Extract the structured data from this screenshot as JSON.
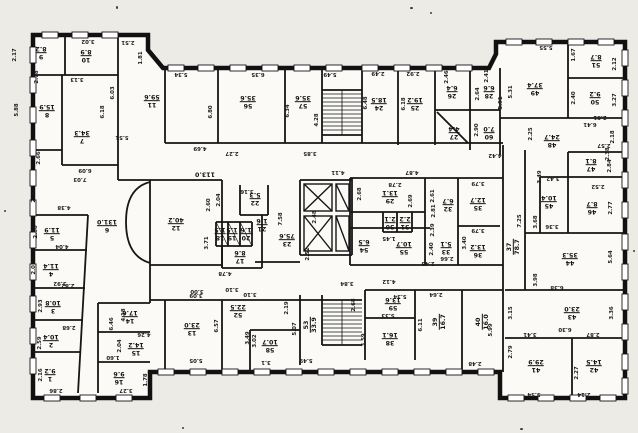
{
  "colors": {
    "paper": "#edebe6",
    "ink": "#161616",
    "wall": "#111111"
  },
  "rooms": [
    {
      "n": "1",
      "a": "9.2",
      "x": 50,
      "y": 374
    },
    {
      "n": "2",
      "a": "10.4",
      "x": 51,
      "y": 340
    },
    {
      "n": "3",
      "a": "10.8",
      "x": 53,
      "y": 306
    },
    {
      "n": "4",
      "a": "11.4",
      "x": 51,
      "y": 269
    },
    {
      "n": "5",
      "a": "11.9",
      "x": 52,
      "y": 233
    },
    {
      "n": "6",
      "a": "131.0",
      "x": 107,
      "y": 225
    },
    {
      "n": "7",
      "a": "34.3",
      "x": 82,
      "y": 136
    },
    {
      "n": "8",
      "a": "15.9",
      "x": 47,
      "y": 110
    },
    {
      "n": "9",
      "a": "8.2",
      "x": 41,
      "y": 52
    },
    {
      "n": "10",
      "a": "8.9",
      "x": 86,
      "y": 55
    },
    {
      "n": "11",
      "a": "59.6",
      "x": 152,
      "y": 100
    },
    {
      "n": "12",
      "a": "40.2",
      "x": 176,
      "y": 223
    },
    {
      "n": "13",
      "a": "23.0",
      "x": 192,
      "y": 328
    },
    {
      "n": "14",
      "a": "17.6",
      "x": 130,
      "y": 316
    },
    {
      "n": "15",
      "a": "14.2",
      "x": 136,
      "y": 348
    },
    {
      "n": "16",
      "a": "9.6",
      "x": 119,
      "y": 377
    },
    {
      "n": "17",
      "a": "8.6",
      "x": 240,
      "y": 256
    },
    {
      "n": "18",
      "a": "1.5",
      "x": 220,
      "y": 233
    },
    {
      "n": "19",
      "a": "1.5",
      "x": 232,
      "y": 233
    },
    {
      "n": "20",
      "a": "1.6",
      "x": 246,
      "y": 233
    },
    {
      "n": "21",
      "a": "1.6",
      "x": 262,
      "y": 224
    },
    {
      "n": "22",
      "a": "5.3",
      "x": 255,
      "y": 198
    },
    {
      "n": "23",
      "a": "75.6",
      "x": 287,
      "y": 239
    },
    {
      "n": "24",
      "a": "18.5",
      "x": 379,
      "y": 103
    },
    {
      "n": "25",
      "a": "19.2",
      "x": 415,
      "y": 103
    },
    {
      "n": "26",
      "a": "6.4",
      "x": 452,
      "y": 91
    },
    {
      "n": "27",
      "a": "4.4",
      "x": 454,
      "y": 132
    },
    {
      "n": "28",
      "a": "6.6",
      "x": 489,
      "y": 91
    },
    {
      "n": "29",
      "a": "13.1",
      "x": 390,
      "y": 196
    },
    {
      "n": "30",
      "a": "2.1",
      "x": 390,
      "y": 222
    },
    {
      "n": "31",
      "a": "2.2",
      "x": 405,
      "y": 222
    },
    {
      "n": "32",
      "a": "6.7",
      "x": 448,
      "y": 204
    },
    {
      "n": "33",
      "a": "5.1",
      "x": 446,
      "y": 247
    },
    {
      "n": "35",
      "a": "12.7",
      "x": 478,
      "y": 203
    },
    {
      "n": "36",
      "a": "13.2",
      "x": 478,
      "y": 250
    },
    {
      "n": "37",
      "a": "78.7",
      "x": 514,
      "y": 247,
      "v": true
    },
    {
      "n": "38",
      "a": "16.1",
      "x": 390,
      "y": 338
    },
    {
      "n": "39",
      "a": "16.7",
      "x": 440,
      "y": 322,
      "v": true
    },
    {
      "n": "40",
      "a": "16.0",
      "x": 483,
      "y": 322,
      "v": true
    },
    {
      "n": "41",
      "a": "29.9",
      "x": 536,
      "y": 365
    },
    {
      "n": "42",
      "a": "14.5",
      "x": 594,
      "y": 365
    },
    {
      "n": "43",
      "a": "23.0",
      "x": 572,
      "y": 312
    },
    {
      "n": "44",
      "a": "35.3",
      "x": 570,
      "y": 258
    },
    {
      "n": "45",
      "a": "10.4",
      "x": 549,
      "y": 201
    },
    {
      "n": "46",
      "a": "8.7",
      "x": 592,
      "y": 207
    },
    {
      "n": "47",
      "a": "8.1",
      "x": 591,
      "y": 164
    },
    {
      "n": "48",
      "a": "24.7",
      "x": 552,
      "y": 140
    },
    {
      "n": "49",
      "a": "37.4",
      "x": 535,
      "y": 88
    },
    {
      "n": "50",
      "a": "9.2",
      "x": 595,
      "y": 97
    },
    {
      "n": "51",
      "a": "8.7",
      "x": 596,
      "y": 60
    },
    {
      "n": "52",
      "a": "22.5",
      "x": 238,
      "y": 310
    },
    {
      "n": "53",
      "a": "33.9",
      "x": 311,
      "y": 325,
      "v": true
    },
    {
      "n": "54",
      "a": "6.5",
      "x": 364,
      "y": 245
    },
    {
      "n": "55",
      "a": "10.7",
      "x": 404,
      "y": 247
    },
    {
      "n": "56",
      "a": "35.6",
      "x": 248,
      "y": 101
    },
    {
      "n": "57",
      "a": "35.6",
      "x": 303,
      "y": 101
    },
    {
      "n": "58",
      "a": "10.7",
      "x": 270,
      "y": 345
    },
    {
      "n": "59",
      "a": "13.6",
      "x": 393,
      "y": 303
    },
    {
      "n": "60",
      "a": "7.0",
      "x": 489,
      "y": 132
    },
    {
      "n": "",
      "a": "113.0",
      "x": 205,
      "y": 174
    }
  ],
  "dims": [
    {
      "t": "2.17",
      "x": 15,
      "y": 55,
      "v": true
    },
    {
      "t": "3.02",
      "x": 88,
      "y": 41
    },
    {
      "t": "2.51",
      "x": 128,
      "y": 42
    },
    {
      "t": "1.81",
      "x": 141,
      "y": 58,
      "v": true
    },
    {
      "t": "5.34",
      "x": 181,
      "y": 74
    },
    {
      "t": "6.35",
      "x": 258,
      "y": 74
    },
    {
      "t": "5.49",
      "x": 330,
      "y": 74
    },
    {
      "t": "2.78",
      "x": 37,
      "y": 77,
      "v": true
    },
    {
      "t": "3.13",
      "x": 77,
      "y": 79
    },
    {
      "t": "6.03",
      "x": 113,
      "y": 93,
      "v": true
    },
    {
      "t": "5.88",
      "x": 17,
      "y": 110,
      "v": true
    },
    {
      "t": "6.18",
      "x": 103,
      "y": 112,
      "v": true
    },
    {
      "t": "6.80",
      "x": 211,
      "y": 112,
      "v": true
    },
    {
      "t": "6.34",
      "x": 288,
      "y": 111,
      "v": true
    },
    {
      "t": "4.28",
      "x": 317,
      "y": 120,
      "v": true
    },
    {
      "t": "5.51",
      "x": 122,
      "y": 137
    },
    {
      "t": "4.69",
      "x": 200,
      "y": 148
    },
    {
      "t": "2.27",
      "x": 232,
      "y": 153
    },
    {
      "t": "3.85",
      "x": 310,
      "y": 153
    },
    {
      "t": "2.49",
      "x": 378,
      "y": 73
    },
    {
      "t": "2.92",
      "x": 413,
      "y": 73
    },
    {
      "t": "2.46",
      "x": 447,
      "y": 77,
      "v": true
    },
    {
      "t": "2.41",
      "x": 487,
      "y": 76,
      "v": true
    },
    {
      "t": "2.64",
      "x": 478,
      "y": 94,
      "v": true
    },
    {
      "t": "2.90",
      "x": 477,
      "y": 130,
      "v": true
    },
    {
      "t": "5.91",
      "x": 501,
      "y": 103,
      "v": true
    },
    {
      "t": "6.48",
      "x": 366,
      "y": 103,
      "v": true
    },
    {
      "t": "6.18",
      "x": 404,
      "y": 104,
      "v": true
    },
    {
      "t": "4.42",
      "x": 495,
      "y": 155
    },
    {
      "t": "5.55",
      "x": 546,
      "y": 47
    },
    {
      "t": "1.67",
      "x": 574,
      "y": 55,
      "v": true
    },
    {
      "t": "2.12",
      "x": 615,
      "y": 64,
      "v": true
    },
    {
      "t": "5.31",
      "x": 511,
      "y": 92,
      "v": true
    },
    {
      "t": "3.27",
      "x": 615,
      "y": 100,
      "v": true
    },
    {
      "t": "2.40",
      "x": 574,
      "y": 98,
      "v": true
    },
    {
      "t": "2.81",
      "x": 600,
      "y": 117
    },
    {
      "t": "6.41",
      "x": 590,
      "y": 124
    },
    {
      "t": "2.25",
      "x": 531,
      "y": 134,
      "v": true
    },
    {
      "t": "2.18",
      "x": 613,
      "y": 137,
      "v": true
    },
    {
      "t": "2.57",
      "x": 604,
      "y": 145
    },
    {
      "t": "2.38",
      "x": 608,
      "y": 154,
      "v": true
    },
    {
      "t": "2.84",
      "x": 610,
      "y": 166,
      "v": true
    },
    {
      "t": "2.52",
      "x": 598,
      "y": 186
    },
    {
      "t": "2.77",
      "x": 611,
      "y": 208,
      "v": true
    },
    {
      "t": "3.42",
      "x": 553,
      "y": 178
    },
    {
      "t": "3.36",
      "x": 552,
      "y": 226
    },
    {
      "t": "5.64",
      "x": 611,
      "y": 257,
      "v": true
    },
    {
      "t": "6.38",
      "x": 557,
      "y": 287
    },
    {
      "t": "3.36",
      "x": 612,
      "y": 313,
      "v": true
    },
    {
      "t": "3.15",
      "x": 511,
      "y": 313,
      "v": true
    },
    {
      "t": "6.30",
      "x": 565,
      "y": 329
    },
    {
      "t": "3.41",
      "x": 530,
      "y": 334
    },
    {
      "t": "2.87",
      "x": 593,
      "y": 334
    },
    {
      "t": "2.79",
      "x": 511,
      "y": 352,
      "v": true
    },
    {
      "t": "2.27",
      "x": 577,
      "y": 373,
      "v": true
    },
    {
      "t": "5.54",
      "x": 534,
      "y": 394
    },
    {
      "t": "2.14",
      "x": 584,
      "y": 394
    },
    {
      "t": "3.49",
      "x": 540,
      "y": 177,
      "v": true
    },
    {
      "t": "3.79",
      "x": 478,
      "y": 183
    },
    {
      "t": "3.79",
      "x": 478,
      "y": 230
    },
    {
      "t": "3.40",
      "x": 465,
      "y": 243,
      "v": true
    },
    {
      "t": "3.68",
      "x": 536,
      "y": 222,
      "v": true
    },
    {
      "t": "7.25",
      "x": 520,
      "y": 221,
      "v": true
    },
    {
      "t": "3.98",
      "x": 536,
      "y": 280,
      "v": true
    },
    {
      "t": "2.61",
      "x": 433,
      "y": 196,
      "v": true
    },
    {
      "t": "2.39",
      "x": 433,
      "y": 230,
      "v": true
    },
    {
      "t": "2.40",
      "x": 432,
      "y": 249,
      "v": true
    },
    {
      "t": "2.66",
      "x": 447,
      "y": 258
    },
    {
      "t": "4.11",
      "x": 338,
      "y": 172
    },
    {
      "t": "4.87",
      "x": 412,
      "y": 172
    },
    {
      "t": "2.78",
      "x": 395,
      "y": 184
    },
    {
      "t": "2.68",
      "x": 360,
      "y": 194,
      "v": true
    },
    {
      "t": "2.69",
      "x": 411,
      "y": 201,
      "v": true
    },
    {
      "t": "2.48",
      "x": 315,
      "y": 217,
      "v": true
    },
    {
      "t": "2.81",
      "x": 434,
      "y": 211,
      "v": true
    },
    {
      "t": "2.52",
      "x": 308,
      "y": 254,
      "v": true
    },
    {
      "t": "1.45",
      "x": 389,
      "y": 238
    },
    {
      "t": "2.43",
      "x": 428,
      "y": 263
    },
    {
      "t": "4.12",
      "x": 389,
      "y": 281
    },
    {
      "t": "3.84",
      "x": 347,
      "y": 283
    },
    {
      "t": "2.60",
      "x": 209,
      "y": 205,
      "v": true
    },
    {
      "t": "2.04",
      "x": 219,
      "y": 200,
      "v": true
    },
    {
      "t": "3.16",
      "x": 247,
      "y": 191
    },
    {
      "t": "7.58",
      "x": 281,
      "y": 219,
      "v": true
    },
    {
      "t": "3.71",
      "x": 207,
      "y": 243,
      "v": true
    },
    {
      "t": "4.78",
      "x": 225,
      "y": 273
    },
    {
      "t": "3.00",
      "x": 197,
      "y": 291
    },
    {
      "t": "3.10",
      "x": 232,
      "y": 289
    },
    {
      "t": "6.09",
      "x": 85,
      "y": 170
    },
    {
      "t": "7.03",
      "x": 80,
      "y": 179
    },
    {
      "t": "2.66",
      "x": 39,
      "y": 158,
      "v": true
    },
    {
      "t": "2.60",
      "x": 34,
      "y": 196,
      "v": true
    },
    {
      "t": "4.38",
      "x": 64,
      "y": 207
    },
    {
      "t": "2.66",
      "x": 36,
      "y": 232,
      "v": true
    },
    {
      "t": "4.04",
      "x": 62,
      "y": 246
    },
    {
      "t": "2.01",
      "x": 34,
      "y": 268,
      "v": true
    },
    {
      "t": "3.92",
      "x": 60,
      "y": 283
    },
    {
      "t": "2.82",
      "x": 68,
      "y": 285
    },
    {
      "t": "2.93",
      "x": 41,
      "y": 306,
      "v": true
    },
    {
      "t": "2.68",
      "x": 69,
      "y": 327
    },
    {
      "t": "2.59",
      "x": 40,
      "y": 343,
      "v": true
    },
    {
      "t": "2.16",
      "x": 41,
      "y": 375,
      "v": true
    },
    {
      "t": "2.86",
      "x": 56,
      "y": 390
    },
    {
      "t": "3.27",
      "x": 126,
      "y": 390
    },
    {
      "t": "1.60",
      "x": 113,
      "y": 357
    },
    {
      "t": "1.78",
      "x": 146,
      "y": 380,
      "v": true
    },
    {
      "t": "4.18",
      "x": 124,
      "y": 315,
      "v": true
    },
    {
      "t": "6.46",
      "x": 112,
      "y": 324,
      "v": true
    },
    {
      "t": "4.26",
      "x": 144,
      "y": 334
    },
    {
      "t": "2.04",
      "x": 120,
      "y": 346,
      "v": true
    },
    {
      "t": "3.09",
      "x": 196,
      "y": 295
    },
    {
      "t": "3.10",
      "x": 250,
      "y": 294
    },
    {
      "t": "5.05",
      "x": 196,
      "y": 360
    },
    {
      "t": "6.57",
      "x": 217,
      "y": 326,
      "v": true
    },
    {
      "t": "2.19",
      "x": 287,
      "y": 308,
      "v": true
    },
    {
      "t": "3.49",
      "x": 248,
      "y": 338,
      "v": true
    },
    {
      "t": "3.02",
      "x": 255,
      "y": 341,
      "v": true
    },
    {
      "t": "5.07",
      "x": 295,
      "y": 329,
      "v": true
    },
    {
      "t": "3.1",
      "x": 266,
      "y": 362
    },
    {
      "t": "5.49",
      "x": 306,
      "y": 360
    },
    {
      "t": "2.68",
      "x": 354,
      "y": 305,
      "v": true
    },
    {
      "t": "5.34",
      "x": 400,
      "y": 296
    },
    {
      "t": "5.33",
      "x": 388,
      "y": 315
    },
    {
      "t": "3.59",
      "x": 364,
      "y": 340,
      "v": true
    },
    {
      "t": "2.64",
      "x": 436,
      "y": 294
    },
    {
      "t": "6.11",
      "x": 421,
      "y": 325,
      "v": true
    },
    {
      "t": "5.99",
      "x": 491,
      "y": 330,
      "v": true
    },
    {
      "t": "2.48",
      "x": 475,
      "y": 363
    }
  ]
}
